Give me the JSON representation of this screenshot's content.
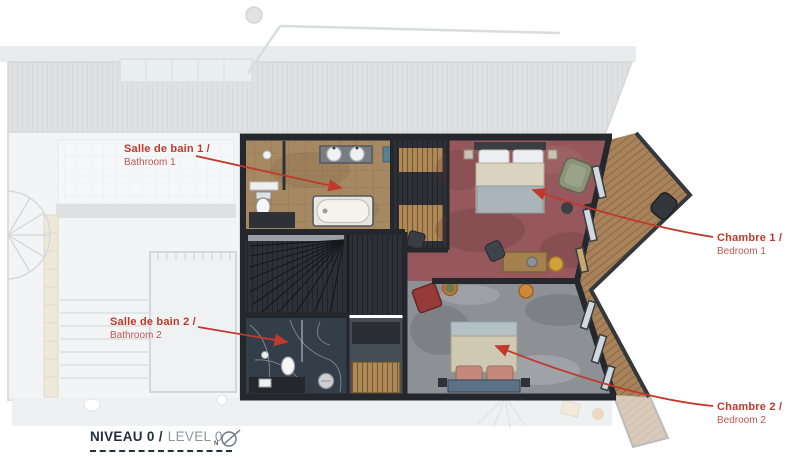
{
  "annotations": {
    "bathroom1": {
      "primary": "Salle de bain 1 /",
      "secondary": "Bathroom 1"
    },
    "bathroom2": {
      "primary": "Salle de bain 2 /",
      "secondary": "Bathroom 2"
    },
    "bedroom1": {
      "primary": "Chambre 1 /",
      "secondary": "Bedroom 1"
    },
    "bedroom2": {
      "primary": "Chambre 2 /",
      "secondary": "Bedroom 2"
    }
  },
  "legend": {
    "level_primary": "NIVEAU 0 /",
    "level_secondary": "LEVEL 0"
  },
  "compass": {
    "north_label": "N"
  },
  "colors": {
    "annotation_red": "#c0392b",
    "annotation_red_soft": "#bf574f",
    "legend_dark": "#22303c",
    "legend_gray": "#8d949b"
  }
}
